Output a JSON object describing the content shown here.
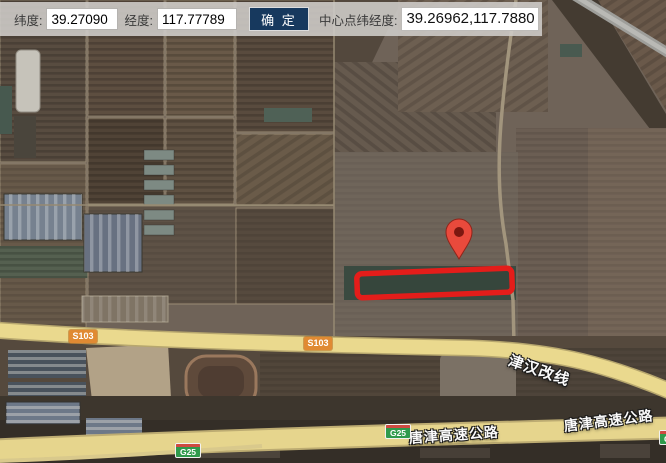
{
  "toolbar": {
    "lat_label": "纬度:",
    "lat_value": "39.27090",
    "lng_label": "经度:",
    "lng_value": "117.77789",
    "confirm_label": "确 定",
    "center_label": "中心点纬经度:",
    "center_value": "39.26962,117.7880"
  },
  "map": {
    "view_type": "satellite",
    "labels": {
      "s103_badge_1": "S103",
      "s103_badge_2": "S103",
      "g25_badge_1": "G25",
      "g25_badge_2": "G25",
      "g25_badge_3": "G25",
      "jinhan_road": "津汉改线",
      "tangjin_road_1": "唐津高速公路",
      "tangjin_road_2": "唐津高速公路"
    },
    "marker": {
      "type": "red-pin",
      "color": "#e94a3c"
    },
    "highlight": {
      "type": "rectangle",
      "stroke_color": "#e41d1a"
    },
    "colors": {
      "road_yellow": "#e8d78d",
      "provincial_badge_orange": "#e08a33",
      "national_badge_green": "#2f9a4c",
      "confirm_button_navy": "#17395e"
    }
  }
}
